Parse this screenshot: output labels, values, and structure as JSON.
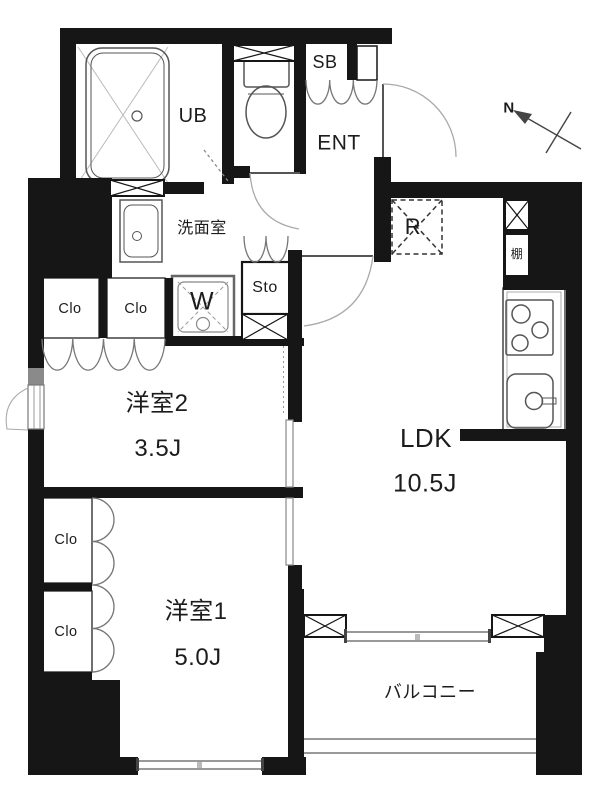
{
  "colors": {
    "wall": "#161616",
    "fixture_line": "#555555",
    "light_line": "#9a9a9a",
    "text": "#1c1c1c",
    "background": "#ffffff"
  },
  "compass": {
    "label": "N"
  },
  "rooms": {
    "unit_bath": {
      "label": "UB"
    },
    "shoe_box": {
      "label": "SB"
    },
    "entrance": {
      "label": "ENT"
    },
    "washroom": {
      "label": "洗面室"
    },
    "washing_machine": {
      "label": "W"
    },
    "storage": {
      "label": "Sto"
    },
    "closet_mid_left": {
      "label": "Clo"
    },
    "closet_mid_right": {
      "label": "Clo"
    },
    "closet_lower_1": {
      "label": "Clo"
    },
    "closet_lower_2": {
      "label": "Clo"
    },
    "bedroom2": {
      "label": "洋室2",
      "area": "3.5J"
    },
    "bedroom1": {
      "label": "洋室1",
      "area": "5.0J"
    },
    "ldk": {
      "label": "LDK",
      "area": "10.5J"
    },
    "balcony": {
      "label": "バルコニー"
    },
    "refrigerator": {
      "label": "R"
    },
    "shelf": {
      "label": "棚"
    }
  }
}
